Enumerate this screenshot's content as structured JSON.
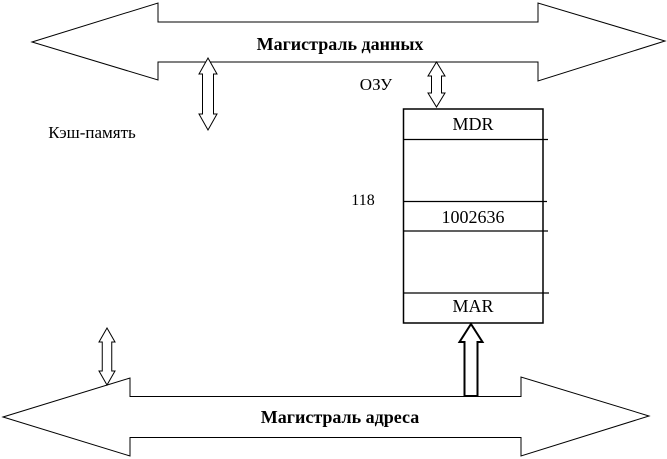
{
  "diagram": {
    "data_bus_label": "Магистраль данных",
    "address_bus_label": "Магистраль адреса",
    "cache_label": "Кэш-память",
    "ram_label": "ОЗУ",
    "address_value": "118",
    "memory_block": {
      "mdr_label": "MDR",
      "cell_value": "1002636",
      "mar_label": "MAR"
    },
    "colors": {
      "stroke": "#000000",
      "background": "#ffffff",
      "text": "#000000"
    }
  }
}
